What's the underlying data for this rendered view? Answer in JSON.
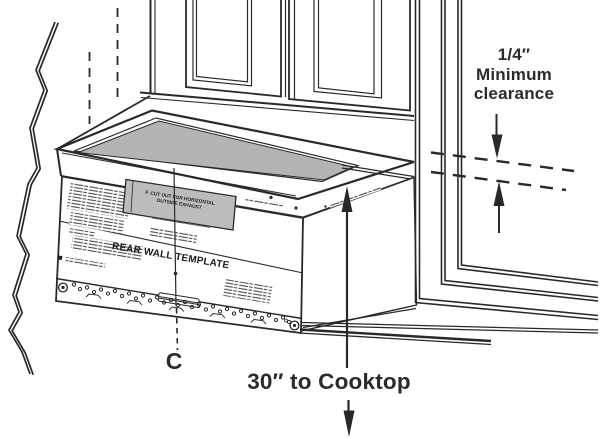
{
  "figure": {
    "type": "microwave-installation-diagram",
    "labels": {
      "clearance_line1": "1/4″",
      "clearance_line2": "Minimum",
      "clearance_line3": "clearance",
      "cooktop_dimension": "30″ to Cooktop",
      "centerline": "C",
      "template_title": "REAR WALL TEMPLATE",
      "exhaust_cutout_line1": "F. CUT OUT FOR HORIZONTAL",
      "exhaust_cutout_line2": "OUTSIDE EXHAUST"
    },
    "colors": {
      "line": "#2b282c",
      "label_text": "#2b2a30",
      "top_surface_gray": "#b4b4b5",
      "cutout_gray": "#bcbcbd",
      "background": "#ffffff"
    }
  }
}
